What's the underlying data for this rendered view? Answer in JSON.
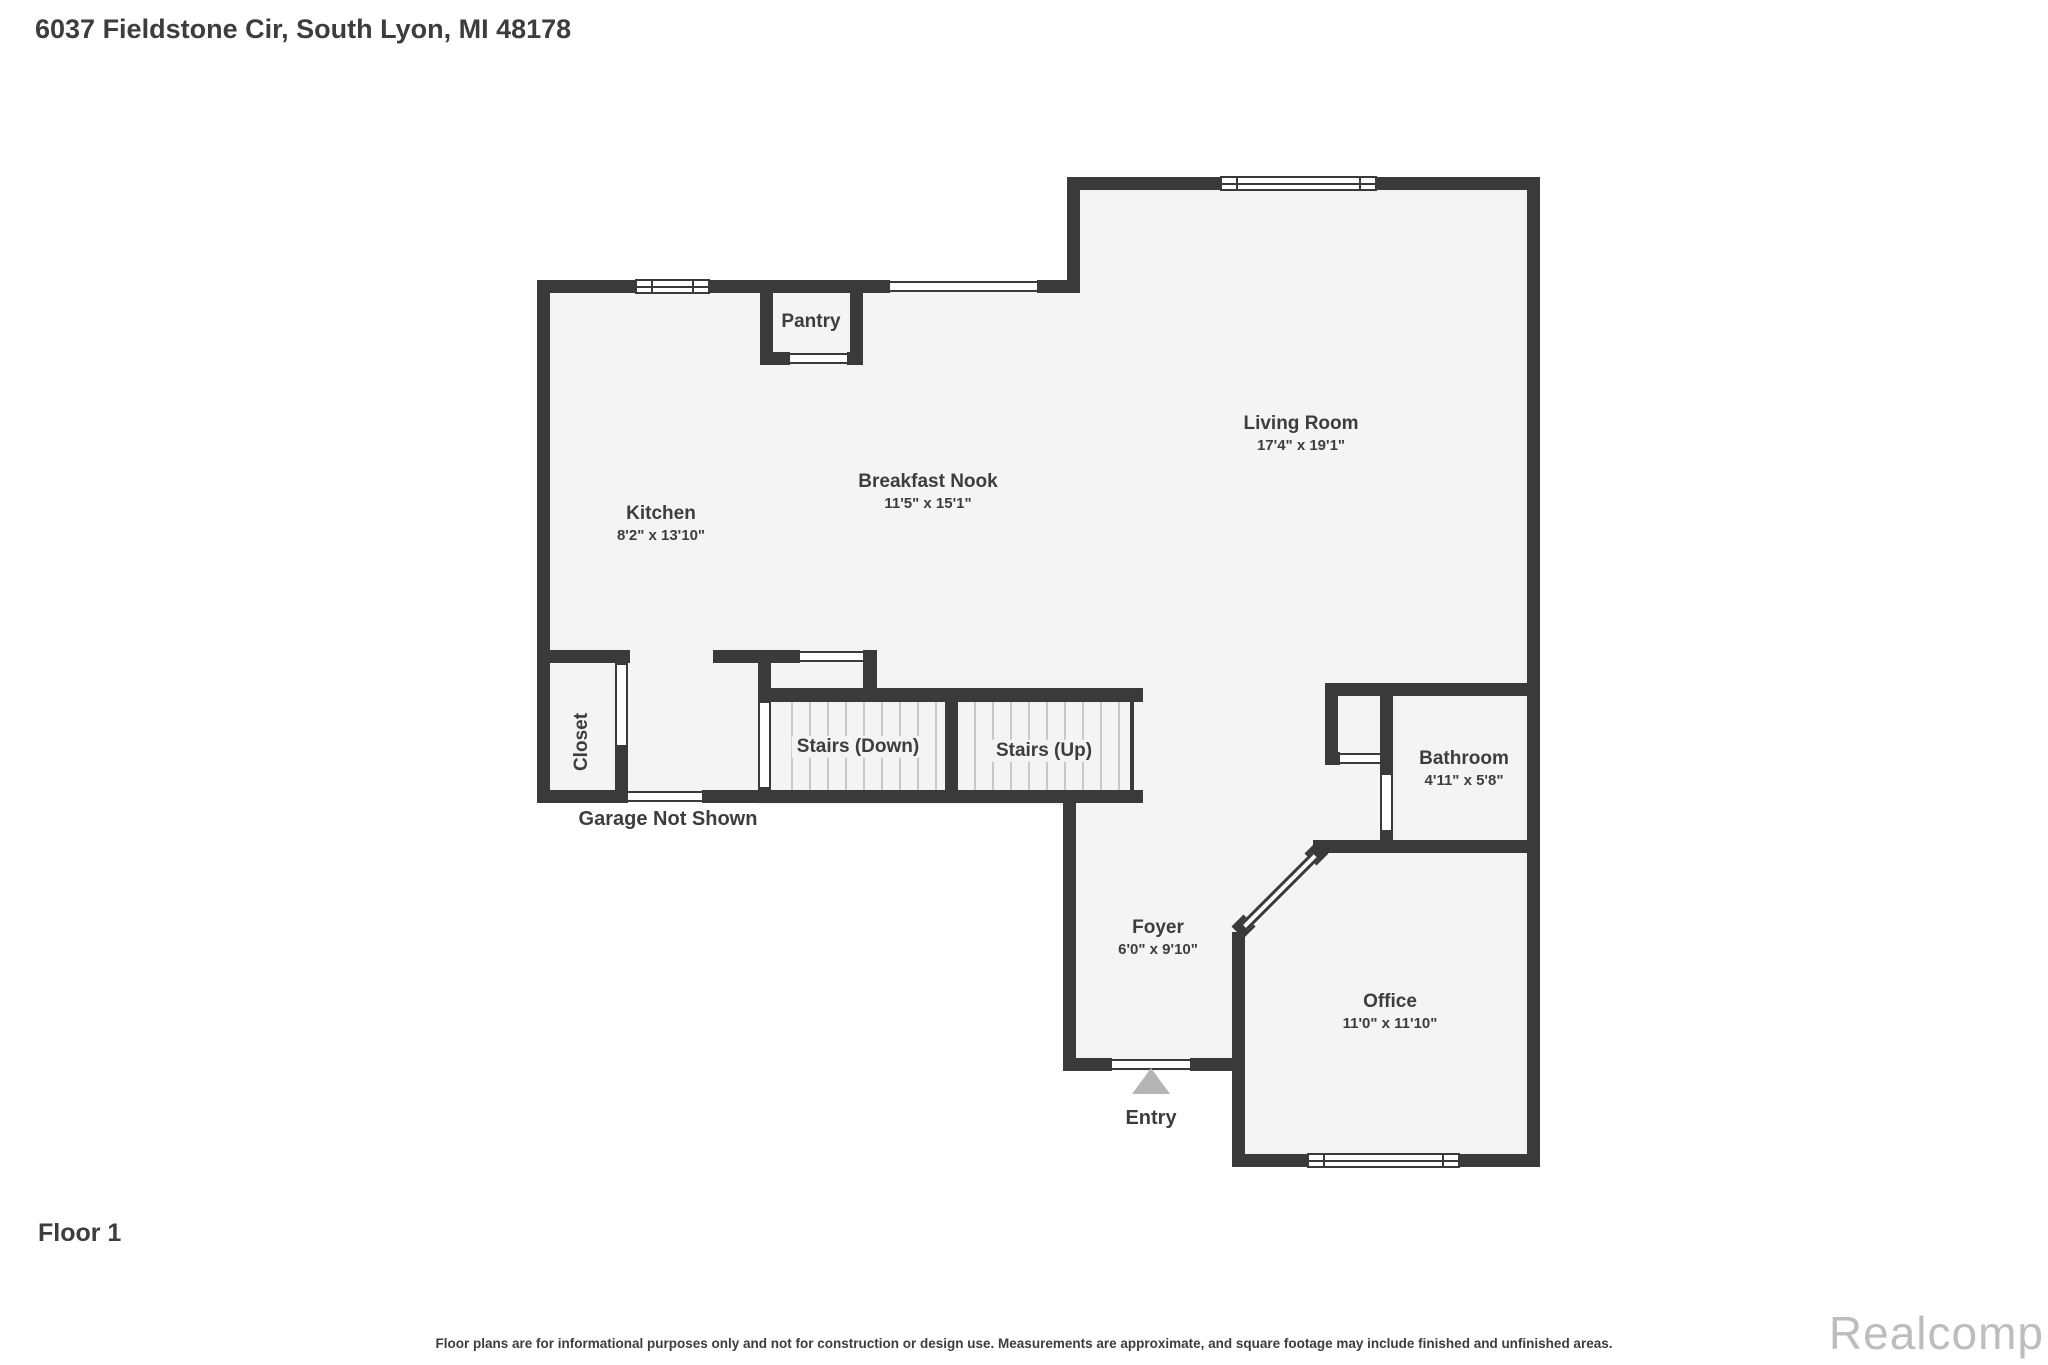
{
  "page_title": "6037 Fieldstone Cir, South Lyon, MI 48178",
  "floor_label": "Floor 1",
  "disclaimer": "Floor plans are for informational purposes only and not for construction or design use. Measurements are approximate, and square footage may include finished and unfinished areas.",
  "watermark": "Realcomp",
  "colors": {
    "wall": "#3a3a3a",
    "floor": "#f4f4f4",
    "text": "#3d3d3d",
    "entry_arrow": "#b5b5b5",
    "stair_tread": "#c8c8c8",
    "watermark": "#bdbdbd"
  },
  "rooms": {
    "kitchen": {
      "name": "Kitchen",
      "dims": "8'2\" x 13'10\""
    },
    "breakfast_nook": {
      "name": "Breakfast Nook",
      "dims": "11'5\" x 15'1\""
    },
    "living_room": {
      "name": "Living Room",
      "dims": "17'4\" x 19'1\""
    },
    "pantry": {
      "name": "Pantry"
    },
    "closet": {
      "name": "Closet"
    },
    "stairs_down": {
      "name": "Stairs (Down)"
    },
    "stairs_up": {
      "name": "Stairs (Up)"
    },
    "bathroom": {
      "name": "Bathroom",
      "dims": "4'11\" x 5'8\""
    },
    "foyer": {
      "name": "Foyer",
      "dims": "6'0\" x 9'10\""
    },
    "office": {
      "name": "Office",
      "dims": "11'0\" x 11'10\""
    }
  },
  "annotations": {
    "garage_note": "Garage Not Shown",
    "entry_label": "Entry"
  }
}
